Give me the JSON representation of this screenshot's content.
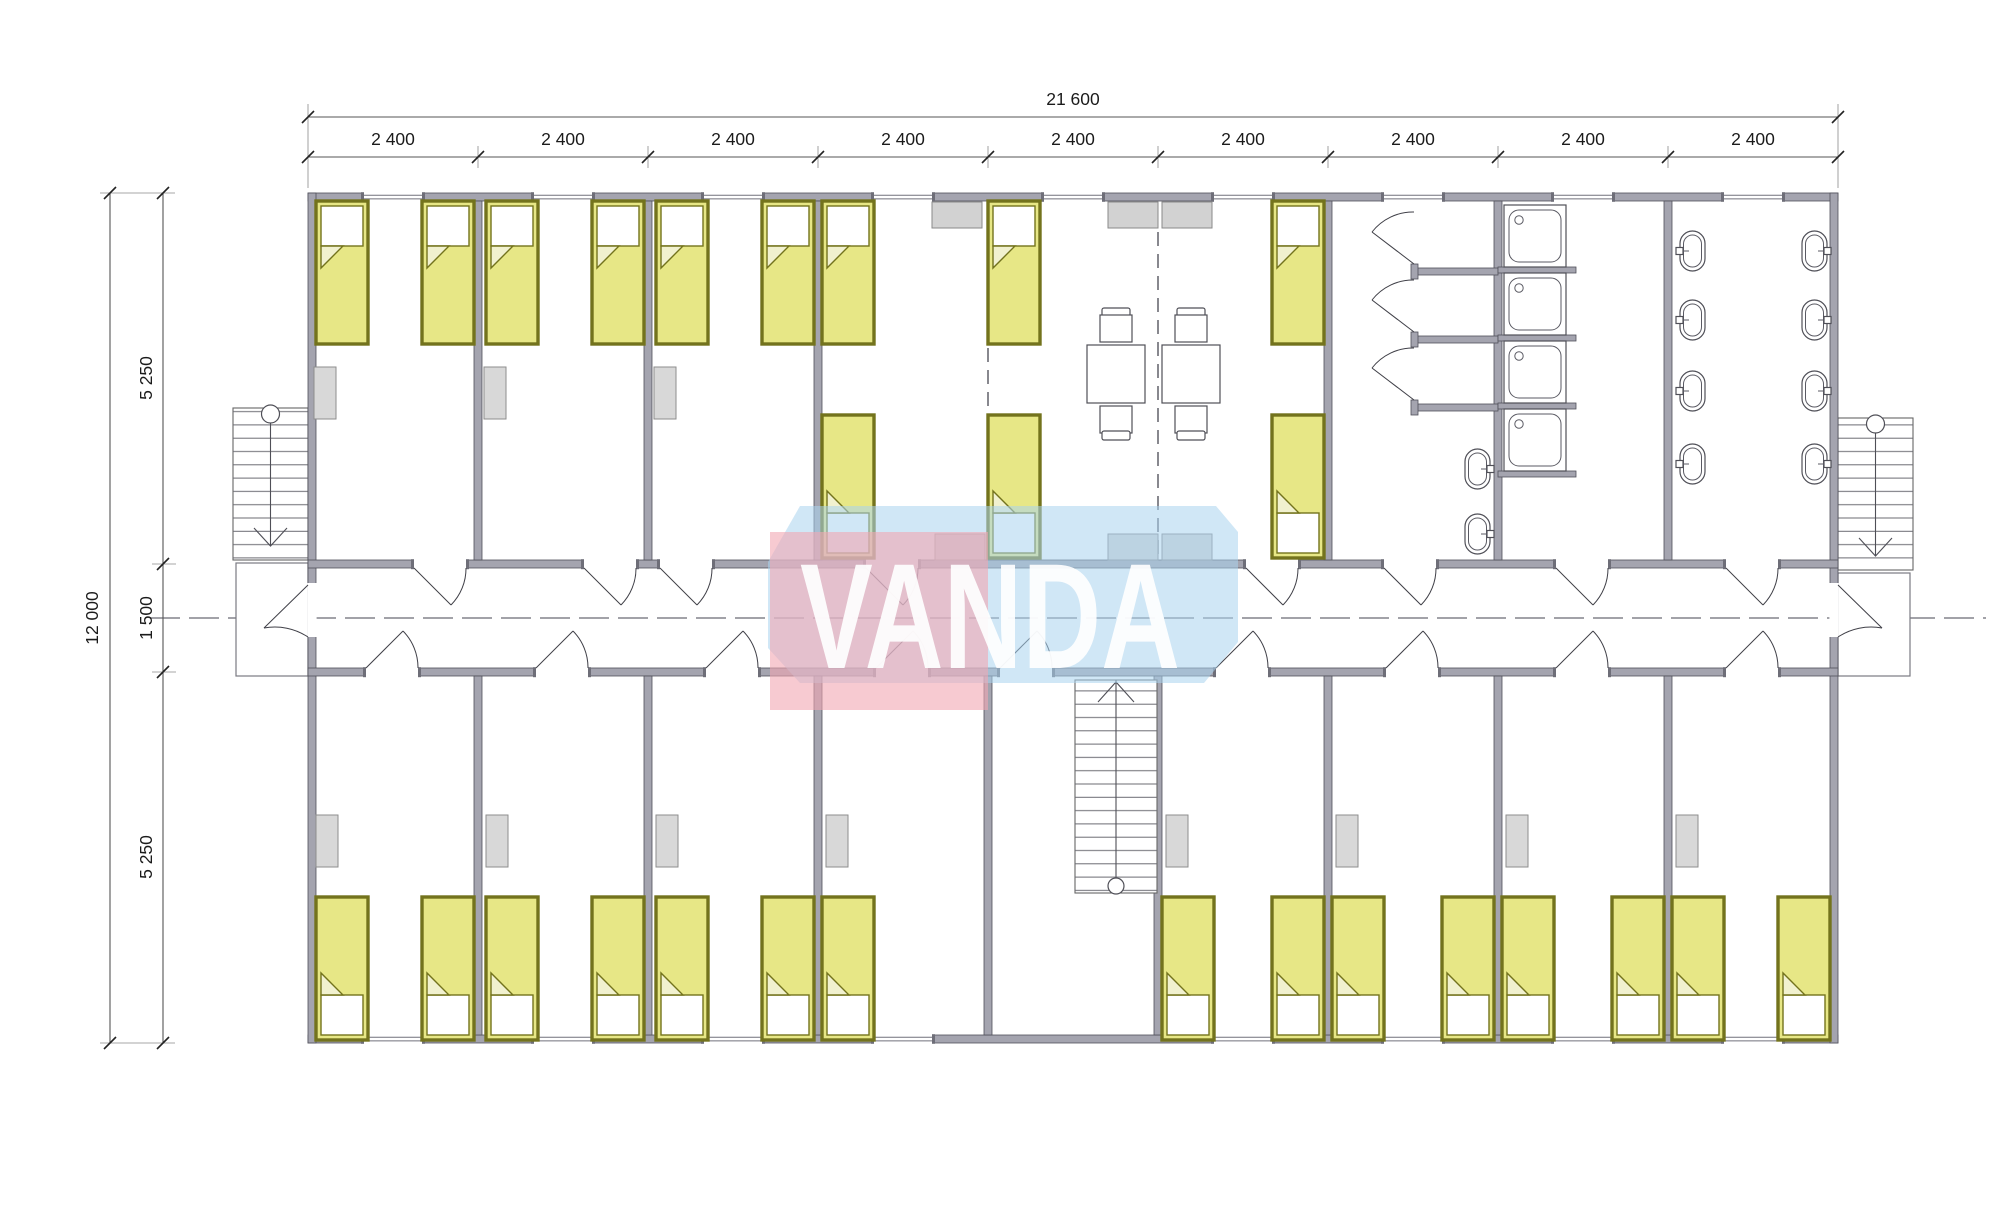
{
  "watermark": {
    "text": "VANDA"
  },
  "dimensions": {
    "top_total_label": "21 600",
    "top_segment_labels": [
      "2 400",
      "2 400",
      "2 400",
      "2 400",
      "2 400",
      "2 400",
      "2 400",
      "2 400",
      "2 400"
    ],
    "left_total_label": "12 000",
    "left_segment_labels": [
      "5 250",
      "1 500",
      "5 250"
    ]
  },
  "inventory": {
    "beds": 27,
    "shower_cabins": 4,
    "wc_stalls": 3,
    "wash_basins": 10,
    "dining_tables": 2,
    "chairs": 4,
    "staircases": 3
  },
  "palette": {
    "bed_fill": "#e7e786",
    "bed_frame": "#73731d",
    "wall_gray": "#a4a4af",
    "furniture_gray": "#d8d8d8",
    "watermark_pink": "#f2a7b2",
    "watermark_blue": "#a9d4ee",
    "watermark_text": "#ffffff"
  }
}
